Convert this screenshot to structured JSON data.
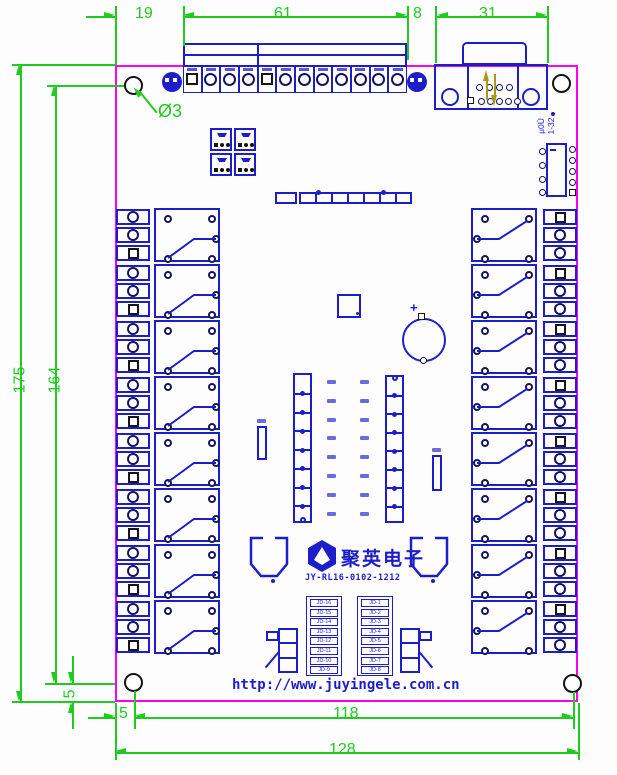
{
  "dimensions": {
    "top_left_offset": "19",
    "terminal_strip_width": "61",
    "strip_to_db9_gap": "8",
    "db9_width": "31",
    "board_height": "175",
    "hole_span_vertical": "164",
    "hole_offset_vertical": "5",
    "hole_offset_horizontal": "5",
    "hole_span_horizontal": "118",
    "board_width": "128",
    "hole_diameter_label": "Ø3"
  },
  "texts": {
    "url": "http://www.juyingele.com.cn",
    "part_number": "JY-RL16-0102-1212",
    "brand": "聚英电子",
    "ic_label_line1": "μ0Ū",
    "ic_label_line2": "1-32",
    "cap_polarity": "+"
  },
  "left_jd_table": [
    "JD-16",
    "JD-15",
    "JD-14",
    "JD-13",
    "JD-12",
    "JD-11",
    "JD-10",
    "JD-9"
  ],
  "right_jd_table": [
    "JD-1",
    "JD-2",
    "JD-3",
    "JD-4",
    "JD-5",
    "JD-6",
    "JD-7",
    "JD-8"
  ],
  "top_terminal_shapes": [
    "square",
    "circle",
    "circle",
    "circle",
    "square",
    "circle",
    "circle",
    "circle",
    "circle",
    "circle",
    "circle",
    "circle"
  ],
  "left_terminal_shapes": [
    "circle",
    "circle",
    "square"
  ],
  "right_terminal_shapes": [
    "square",
    "circle",
    "circle"
  ],
  "counts": {
    "relays_per_side": 8,
    "jumper_cells": 4,
    "driver_segments": 8,
    "led_segments": 6,
    "center_label_rows": 8
  },
  "colors": {
    "board_outline": "#ff00f0",
    "component_blue": "#1e1ec8",
    "dimension_green": "#1fcb1f",
    "hole_black": "#151515",
    "arrow_olive": "#a89a18"
  }
}
